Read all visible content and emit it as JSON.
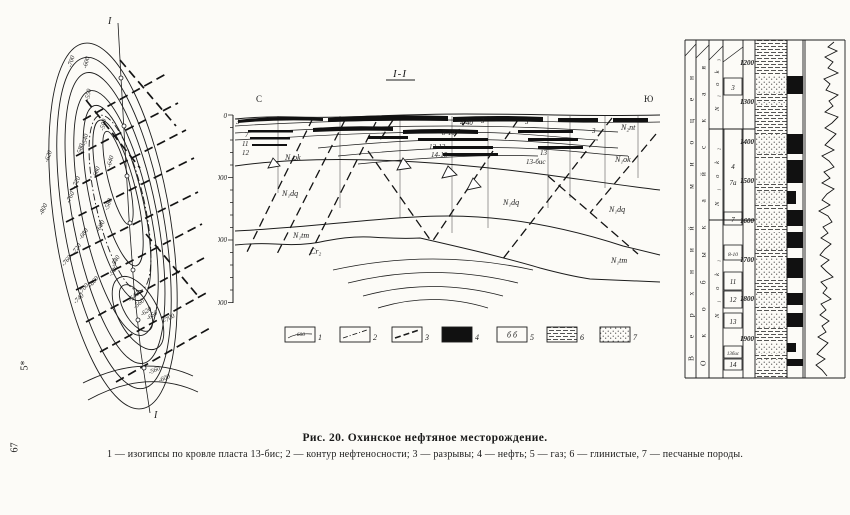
{
  "page": {
    "margin_note": "5*",
    "page_number": "67"
  },
  "caption": {
    "title": "Рис. 20. Охинское нефтяное месторождение.",
    "legend_line": "1 — изогипсы по кровле пласта 13-бис; 2 — контур нефтеносности; 3 — разрывы; 4 — нефть; 5 — газ; 6 — глинистые, 7 — песчаные породы."
  },
  "map": {
    "section_mark_top": "I",
    "section_mark_bottom": "I",
    "contour_labels": [
      "-700",
      "-600",
      "-550",
      "-500",
      "-540",
      "-580",
      "-620",
      "-640",
      "-680",
      "-720",
      "-760",
      "-800",
      "-580",
      "-600",
      "-680",
      "-720",
      "-760",
      "-540",
      "-580",
      "-660",
      "-700",
      "-740",
      "-540",
      "-560",
      "-620",
      "-660",
      "-700",
      "-560",
      "-600"
    ]
  },
  "section": {
    "title": "I-I",
    "north": "С",
    "south": "Ю",
    "depth_ticks": [
      "0",
      "1000",
      "2000",
      "3000"
    ],
    "left_beds": [
      "3",
      "7",
      "11",
      "12"
    ],
    "bed_labels": {
      "b4_40": "4-40",
      "b3a": "3",
      "b8_10": "8-10",
      "b12_13": "12-13",
      "b14_15": "14-15",
      "b13": "13",
      "b13bis": "13-бис",
      "b3b": "3",
      "b3c": "3"
    },
    "formations": {
      "n1ok_left": "N₁ok",
      "n1dq_left": "N₁dq",
      "n1tm_left": "N₁tm",
      "cr2": "Cr₂",
      "n1dq_mid": "N₁dq",
      "n2nt": "N₂nt",
      "n1ok_right": "N₁ok",
      "n1dq_right": "N₁dq",
      "n1tm_right": "N₁tm"
    }
  },
  "legend": {
    "items": [
      {
        "num": "1",
        "box_text": "-600"
      },
      {
        "num": "2"
      },
      {
        "num": "3"
      },
      {
        "num": "4"
      },
      {
        "num": "5",
        "box_text": "б б"
      },
      {
        "num": "6"
      },
      {
        "num": "7"
      }
    ]
  },
  "column": {
    "era": "Верхний миоцен",
    "suite": "Окобыкайская",
    "horizons": [
      "N₁ok₃",
      "N₁ok₂",
      "N₁ok₁"
    ],
    "beds": [
      "3",
      "4",
      "7а",
      "7",
      "8-10",
      "11",
      "12",
      "13",
      "13бис",
      "14"
    ],
    "depths": [
      "1200",
      "1300",
      "1400",
      "1500",
      "1600",
      "1700",
      "1800",
      "1900"
    ]
  }
}
